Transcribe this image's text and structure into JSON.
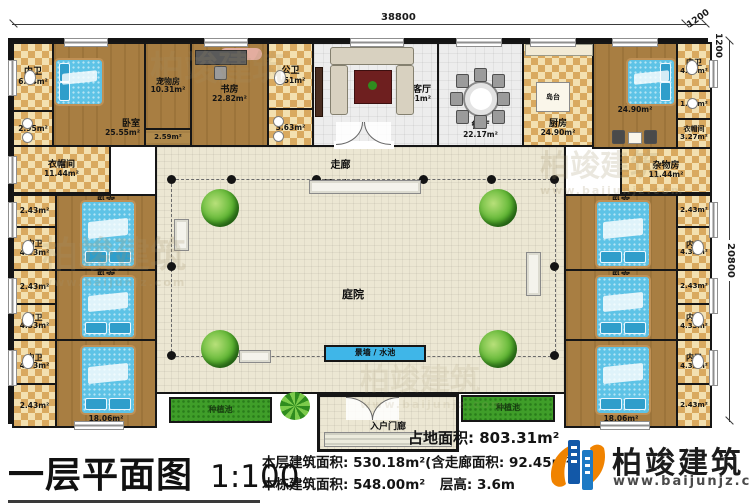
{
  "dims": {
    "top_width": "38800",
    "right_height": "20800",
    "corner_h": "1200",
    "corner_v": "1200"
  },
  "rooms": {
    "nw_bath": {
      "name": "内卫",
      "area": "6.44m²"
    },
    "nw_bath2": {
      "area": "2.95m²"
    },
    "nw_bedroom": {
      "name": "卧室",
      "area": "25.55m²"
    },
    "pet_room": {
      "name": "宠物房",
      "area": "10.31m²"
    },
    "pet_small": {
      "area": "2.59m²"
    },
    "study": {
      "name": "书房",
      "area": "22.82m²"
    },
    "public_bath": {
      "name": "公卫",
      "area": "7.51m²"
    },
    "public_bath2": {
      "area": "3.63m²"
    },
    "living": {
      "name": "客厅",
      "area": "36.91m²"
    },
    "dining": {
      "name": "餐厅",
      "area": "22.17m²"
    },
    "kitchen": {
      "name": "厨房",
      "area": "24.90m²"
    },
    "island": {
      "name": "岛台"
    },
    "ne_bedroom": {
      "name": "卧室",
      "area": "24.90m²"
    },
    "ne_bath": {
      "name": "内卫",
      "area": "4.01m²"
    },
    "ne_bath2": {
      "area": "1.90m²"
    },
    "ne_closet": {
      "name": "衣帽间",
      "area": "3.27m²"
    },
    "w_closet": {
      "name": "衣帽间",
      "area": "11.44m²"
    },
    "e_storage": {
      "name": "杂物房",
      "area": "11.44m²"
    },
    "corridor": {
      "name": "走廊",
      "area": "92.45m²"
    },
    "courtyard": {
      "name": "庭院"
    },
    "water": {
      "name": "景墙 / 水池"
    },
    "planter_left": {
      "name": "种植池"
    },
    "planter_right": {
      "name": "种植池"
    },
    "porch": {
      "name": "入户门廊"
    },
    "l_bed1": {
      "name": "卧室",
      "area": "18.06m²"
    },
    "l_bed2": {
      "name": "卧室",
      "area": "18.06m²"
    },
    "l_bed3": {
      "name": "卧室",
      "area": "18.06m²"
    },
    "l_bath1": {
      "name": "内卫",
      "area": "4.33m²"
    },
    "l_bath2": {
      "name": "内卫",
      "area": "4.33m²"
    },
    "l_bath3": {
      "name": "内卫",
      "area": "4.33m²"
    },
    "l_closet1": {
      "area": "2.43m²"
    },
    "l_closet2": {
      "area": "2.43m²"
    },
    "l_closet3": {
      "area": "2.43m²"
    },
    "r_bed1": {
      "name": "卧室",
      "area": "18.06m²"
    },
    "r_bed2": {
      "name": "卧室",
      "area": "18.06m²"
    },
    "r_bed3": {
      "name": "卧室",
      "area": "18.06m²"
    },
    "r_bath1": {
      "name": "内卫",
      "area": "4.33m²"
    },
    "r_bath2": {
      "name": "内卫",
      "area": "4.33m²"
    },
    "r_bath3": {
      "name": "内卫",
      "area": "4.33m²"
    },
    "r_closet1": {
      "area": "2.43m²"
    },
    "r_closet2": {
      "area": "2.43m²"
    },
    "r_closet3": {
      "area": "2.43m²"
    }
  },
  "footer": {
    "title": "一层平面图",
    "scale": "1:100",
    "land": "占地面积: 803.31m²",
    "floor": "本层建筑面积: 530.18m²(含走廊面积: 92.45m²)",
    "building": "本栋建筑面积: 548.00m²",
    "height": "层高: 3.6m"
  },
  "logo": {
    "name": "柏竣建筑",
    "url": "www.baijunjz.com"
  },
  "watermark": {
    "text": "柏竣建筑",
    "url": "www.baijunjz.com"
  }
}
